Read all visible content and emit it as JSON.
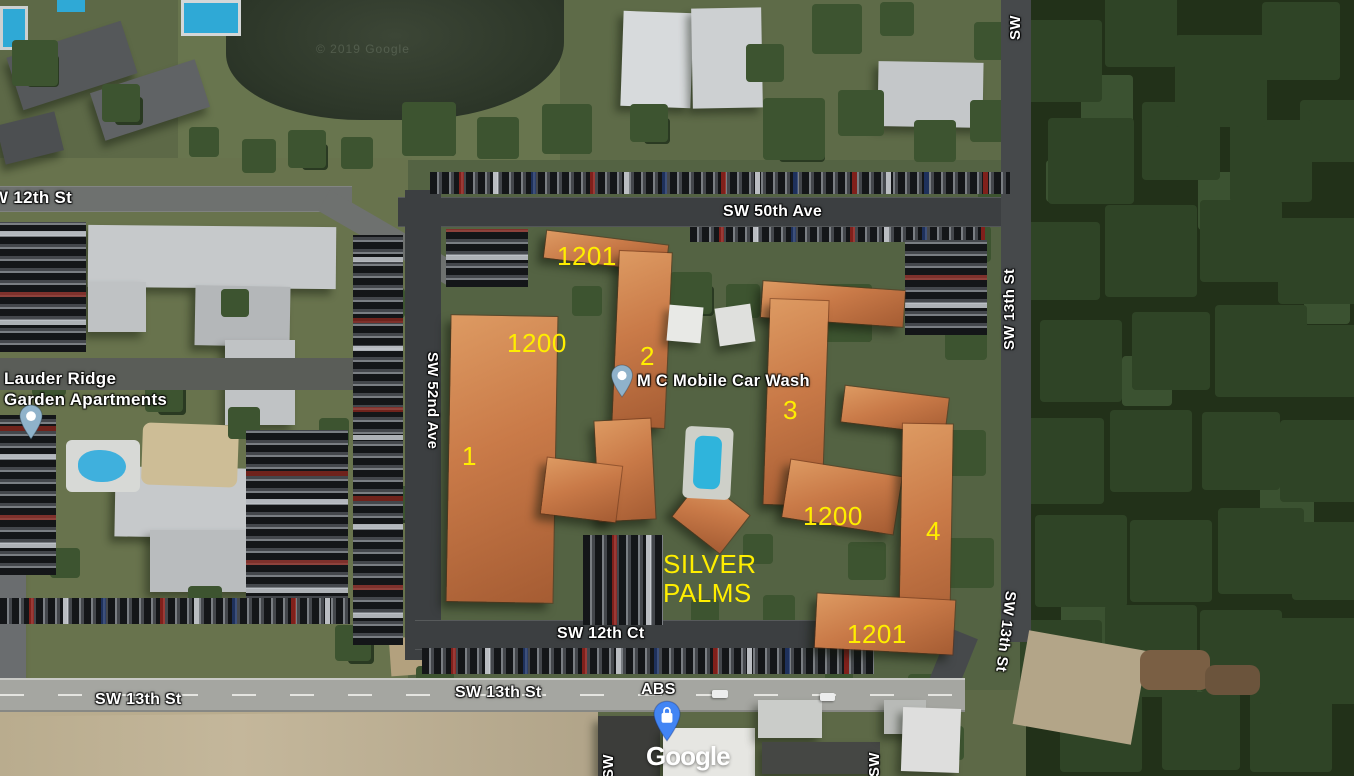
{
  "streets": {
    "w12th": "W 12th St",
    "sw50th": "SW 50th Ave",
    "sw52nd": "SW 52nd Ave",
    "sw13th_right_top": "SW 13th St",
    "sw13th_right_bottom": "SW 13th St",
    "sw12th_ct": "SW 12th Ct",
    "sw13th_bottom_left": "SW 13th St",
    "sw13th_bottom_center": "SW 13th St",
    "sw_top_right": "SW",
    "sw_bottom_left": "SW",
    "sw_bottom_right": "SW"
  },
  "places": {
    "lauder_ridge": "Lauder Ridge\nGarden Apartments",
    "car_wash": "M C Mobile Car Wash",
    "abs": "ABS"
  },
  "annotations": {
    "bld1201_top": "1201",
    "bld1200_left": "1200",
    "num1": "1",
    "num2": "2",
    "num3": "3",
    "bld1200_right": "1200",
    "num4": "4",
    "silver_palms": "SILVER\nPALMS",
    "bld1201_bottom": "1201"
  },
  "watermarks": {
    "copyright": "© 2019 Google",
    "logo": "Google"
  },
  "colors": {
    "annotation_yellow": "#ffee00",
    "street_label_white": "#ffffff",
    "poi_pin_blue": "#8fb2ca",
    "store_pin_blue": "#4285f4"
  }
}
